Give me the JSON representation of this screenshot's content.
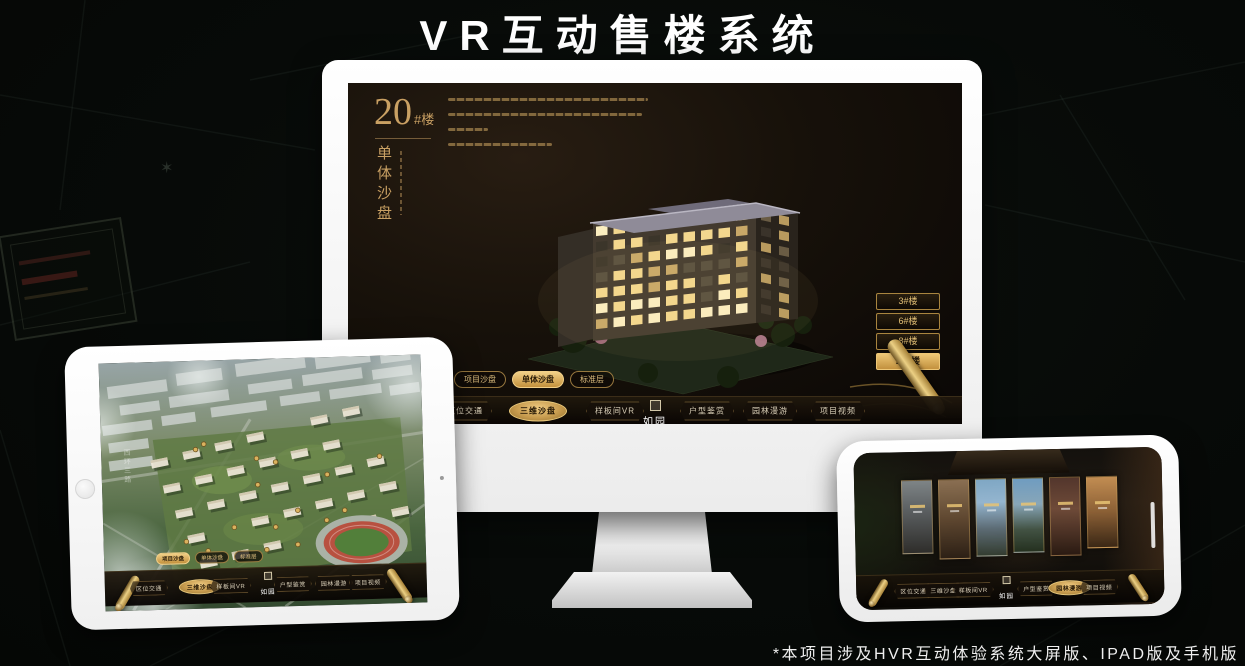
{
  "page": {
    "title": "VR互动售楼系统",
    "footnote": "*本项目涉及HVR互动体验系统大屏版、IPAD版及手机版"
  },
  "colors": {
    "gold": "#c9a063",
    "gold_bright": "#e8c87c",
    "gold_deep": "#9a7434",
    "screen_bg": "#16100a",
    "page_bg": "#070b09",
    "device_white": "#ffffff"
  },
  "brand": {
    "logo_text": "如园"
  },
  "desktop_ui": {
    "building_label": {
      "number": "20",
      "suffix": "#楼",
      "subtitle": "单体沙盘"
    },
    "floor_buttons": [
      {
        "label": "3#楼",
        "active": false
      },
      {
        "label": "6#楼",
        "active": false
      },
      {
        "label": "8#楼",
        "active": false
      },
      {
        "label": "20#楼",
        "active": true
      }
    ],
    "sub_tabs": [
      {
        "label": "项目沙盘",
        "active": false
      },
      {
        "label": "单体沙盘",
        "active": true
      },
      {
        "label": "标准层",
        "active": false
      }
    ],
    "nav_items": [
      {
        "label": "区位交通",
        "active": false
      },
      {
        "label": "三维沙盘",
        "active": true
      },
      {
        "label": "样板间VR",
        "active": false
      },
      {
        "label": "户型鉴赏",
        "active": false
      },
      {
        "label": "园林漫游",
        "active": false
      },
      {
        "label": "项目视频",
        "active": false
      }
    ]
  },
  "tablet_ui": {
    "map_label": "西环三路",
    "sub_tabs": [
      {
        "label": "项目沙盘",
        "active": true
      },
      {
        "label": "单体沙盘",
        "active": false
      },
      {
        "label": "标准层",
        "active": false
      }
    ],
    "nav_items": [
      {
        "label": "区位交通",
        "active": false
      },
      {
        "label": "三维沙盘",
        "active": true
      },
      {
        "label": "样板间VR",
        "active": false
      },
      {
        "label": "户型鉴赏",
        "active": false
      },
      {
        "label": "园林漫游",
        "active": false
      },
      {
        "label": "项目视频",
        "active": false
      }
    ]
  },
  "phone_ui": {
    "nav_items": [
      {
        "label": "区位交通",
        "active": false
      },
      {
        "label": "三维沙盘",
        "active": false
      },
      {
        "label": "样板间VR",
        "active": false
      },
      {
        "label": "户型鉴赏",
        "active": false
      },
      {
        "label": "园林漫游",
        "active": true
      },
      {
        "label": "项目视频",
        "active": false
      }
    ],
    "gallery_panels": [
      {
        "name": "courtyard"
      },
      {
        "name": "interior-warm"
      },
      {
        "name": "building-sky"
      },
      {
        "name": "garden"
      },
      {
        "name": "interior-red"
      },
      {
        "name": "interior-bright"
      }
    ]
  }
}
